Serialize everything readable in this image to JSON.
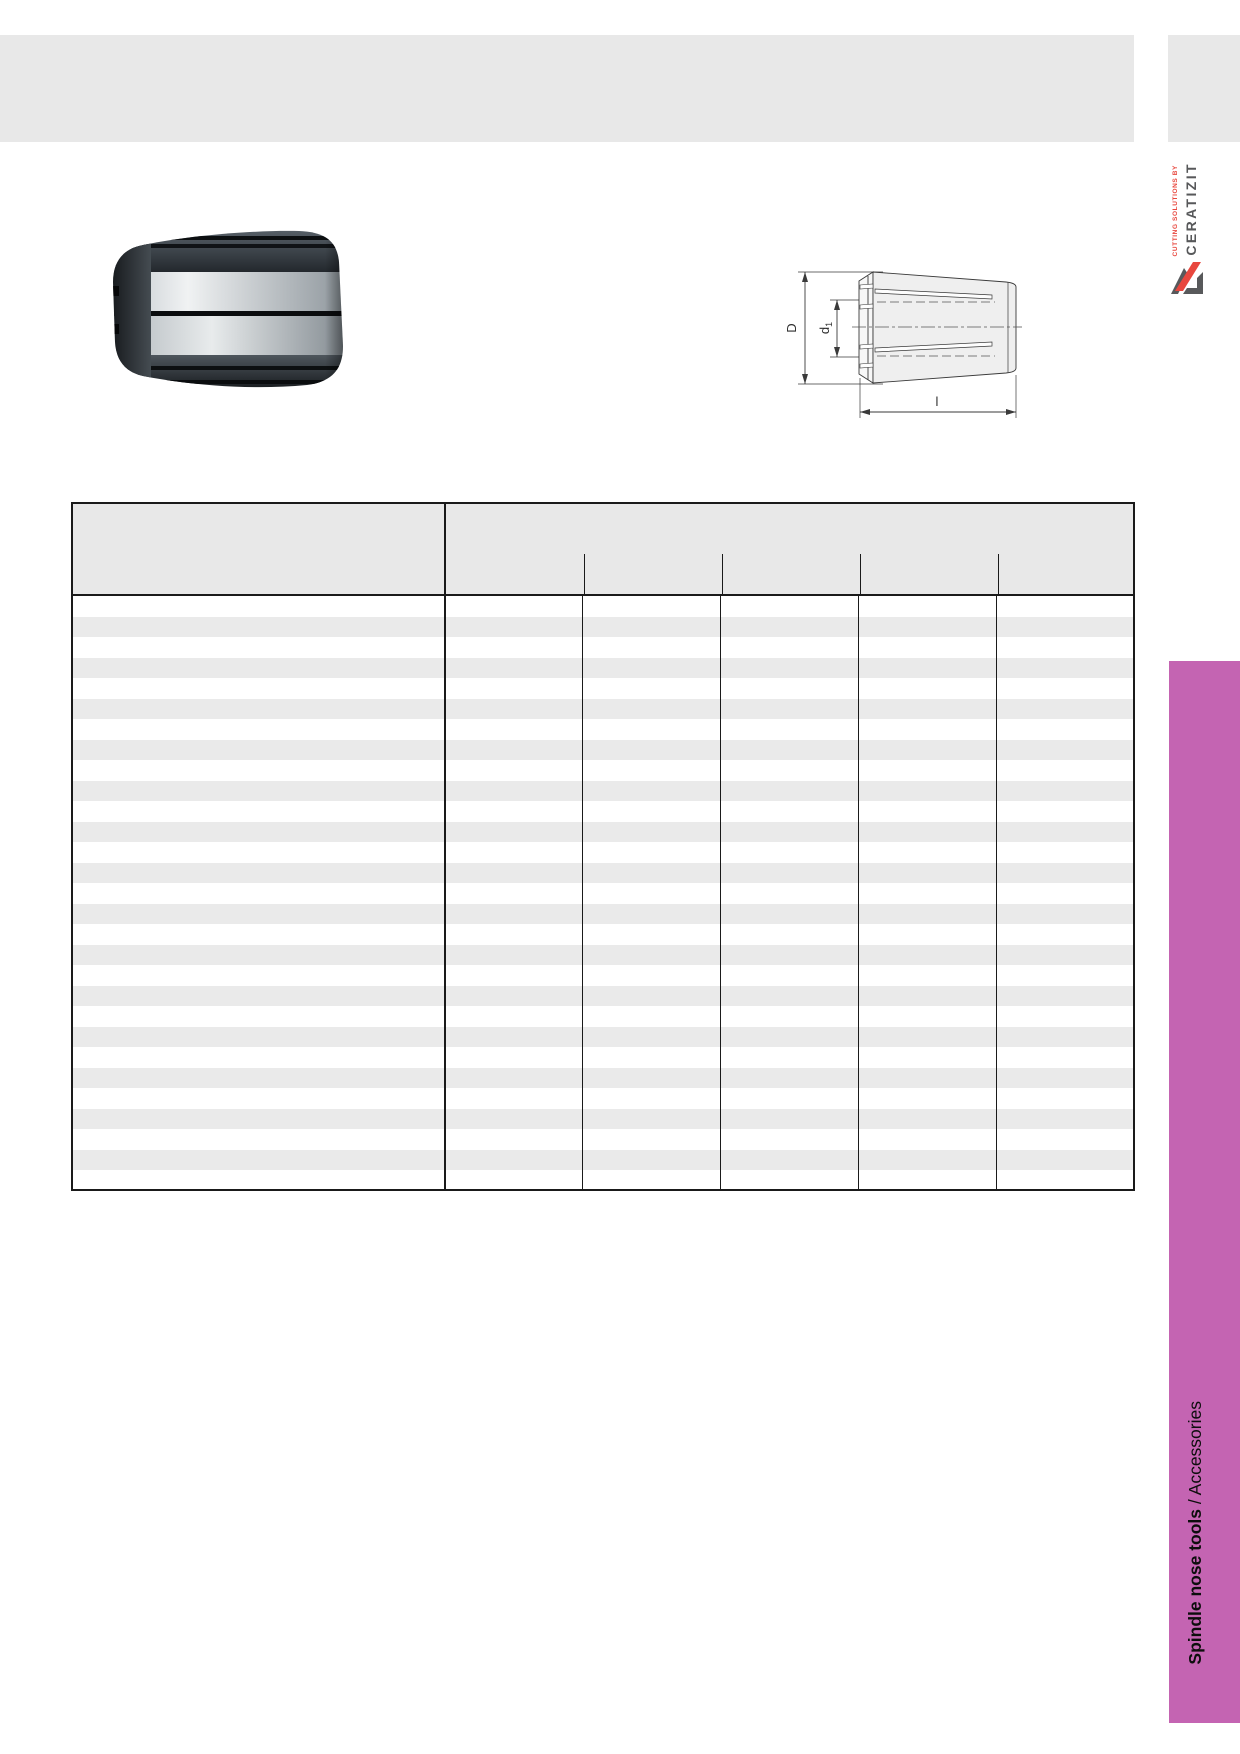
{
  "header": {
    "band_color": "#e8e8e8"
  },
  "logo": {
    "tagline": "CUTTING SOLUTIONS BY",
    "brand": "CERATIZIT",
    "red": "#e8473e",
    "gray": "#57585a"
  },
  "drawing": {
    "labels": {
      "outer_diameter": "D",
      "bore_diameter_base": "d",
      "bore_diameter_sub": "1",
      "length": "l"
    }
  },
  "table": {
    "row_count": 29,
    "column_count": 6,
    "cells_empty": true,
    "stripe_color": "#eaeaea",
    "border_color": "#1a1a1a"
  },
  "sidebar": {
    "accent_color": "#c464b2",
    "label_bold": "Spindle nose tools",
    "label_regular": "/ Accessories"
  }
}
